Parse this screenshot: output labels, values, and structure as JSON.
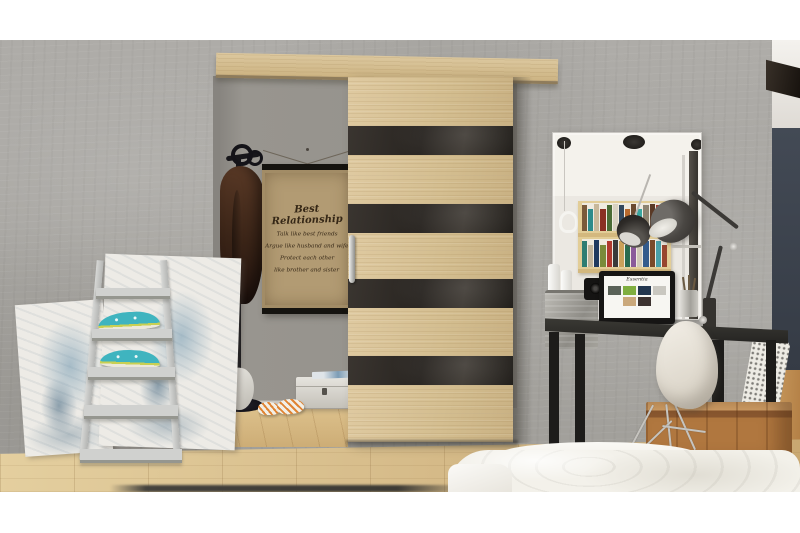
{
  "scene": {
    "description": "Interior product photo: wood sliding barn-style door with black glass stripes on a concrete wall, framed mirror over a black desk with white shell chair, ladder shelf with teal espadrilles and abstract paintings, coat rack with brown coat, framed quote poster, white bed in foreground",
    "poster": {
      "title": "Best Relationship",
      "lines": [
        "Talk like best friends",
        "Argue like husband and wife",
        "Protect each other",
        "like brother and sister"
      ]
    },
    "monitor": {
      "title": "Essentia"
    },
    "palette": {
      "photo_margin": "#ffffff",
      "concrete_wall": "#a9a7a3",
      "doorway_wall": "#94918b",
      "door_wood": "#d5bf93",
      "door_stripe": "#2b2723",
      "rail_wood": "#d4c094",
      "floor_oak": "#d7bc8a",
      "navy_wall": "#3a414c",
      "desk_black": "#232220",
      "chair_white": "#ece8e0",
      "crate_wood": "#b0773f",
      "bed_white": "#f3f1ea",
      "ladder_gray": "#c9cac8",
      "shoe_teal": "#3fb4bf",
      "poster_paper": "#b29b73",
      "poster_frame": "#15130f",
      "poster_ink": "#352716"
    },
    "mirror_books_top": [
      "#7a5a3a",
      "#2e8b8b",
      "#c8b89a",
      "#8a2f23",
      "#4a6b35",
      "#d9d2c2",
      "#34495e",
      "#b86a2e",
      "#6b4a2f",
      "#3aa6a0",
      "#8d8370",
      "#5b3a26",
      "#a93c2e",
      "#2f4d3a"
    ],
    "mirror_books_bottom": [
      "#2e7d72",
      "#c2b59b",
      "#1f3a5f",
      "#7a8b3a",
      "#b03a2e",
      "#3a3a3a",
      "#caa15a",
      "#2a6b4f",
      "#8a5a9a",
      "#d0c9b8",
      "#335b8c",
      "#7a4a2a",
      "#4aa0a8",
      "#97452f"
    ],
    "screen_thumbs": [
      "#5a6258",
      "#7fae3f",
      "#23364e",
      "#c9c7c0",
      "#caa87b",
      "#3c3230"
    ],
    "book_stack_left": [
      "#f0ede6",
      "#e6e2d8",
      "#efece4"
    ],
    "book_stack_right": [
      "#4a7d3a",
      "#c8b33a",
      "#2e5d8a",
      "#a93c2e"
    ]
  }
}
